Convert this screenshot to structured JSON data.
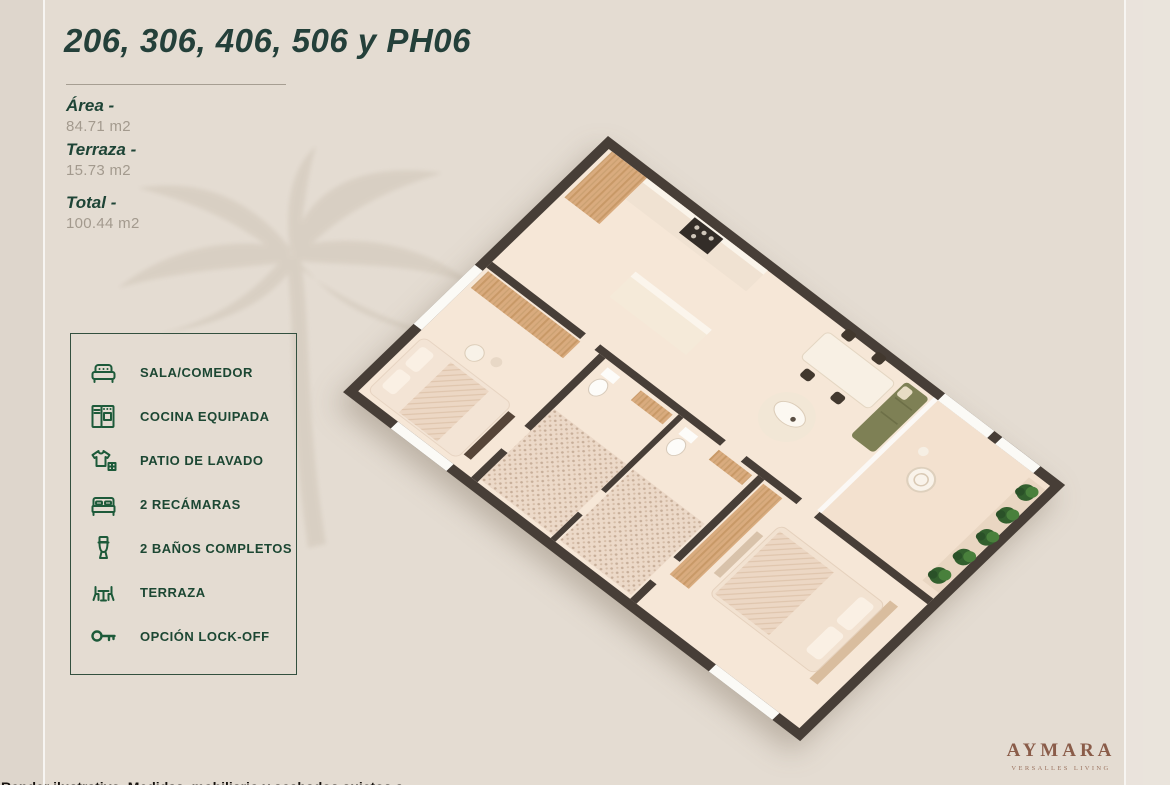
{
  "page": {
    "background": "#e4dcd2"
  },
  "header": {
    "title": "206, 306, 406, 506 y PH06"
  },
  "areas": {
    "area": {
      "label": "Área -",
      "value": "84.71 m2"
    },
    "terraza": {
      "label": "Terraza -",
      "value": "15.73 m2"
    },
    "total": {
      "label": "Total -",
      "value": "100.44 m2"
    }
  },
  "features": {
    "items": [
      {
        "icon": "sofa-icon",
        "label": "SALA/COMEDOR"
      },
      {
        "icon": "kitchen-icon",
        "label": "COCINA EQUIPADA"
      },
      {
        "icon": "laundry-icon",
        "label": "PATIO DE LAVADO"
      },
      {
        "icon": "bed-icon",
        "label": "2 RECÁMARAS"
      },
      {
        "icon": "toilet-icon",
        "label": "2 BAÑOS COMPLETOS"
      },
      {
        "icon": "terrace-icon",
        "label": "TERRAZA"
      },
      {
        "icon": "key-icon",
        "label": "OPCIÓN LOCK-OFF"
      }
    ]
  },
  "floor_plan": {
    "description": "isometric-3d-render-two-bedroom-apartment"
  },
  "brand": {
    "name": "AYMARA",
    "tagline": "VERSALLES LIVING"
  },
  "footer": {
    "clipped_text": "Render ilustrativo. Medidas, mobiliario y acabados sujetos a cambios"
  },
  "colors": {
    "background": "#e4dcd2",
    "title_green": "#24403a",
    "accent_green": "#1d5a3a",
    "value_gray": "#a39a8e",
    "brand_brown": "#8a5c49",
    "wall": "#473e37",
    "floor": "#f6e7d7",
    "wood": "#d9ab7e",
    "sofa_green": "#7e8055",
    "plant_green": "#33602e"
  }
}
